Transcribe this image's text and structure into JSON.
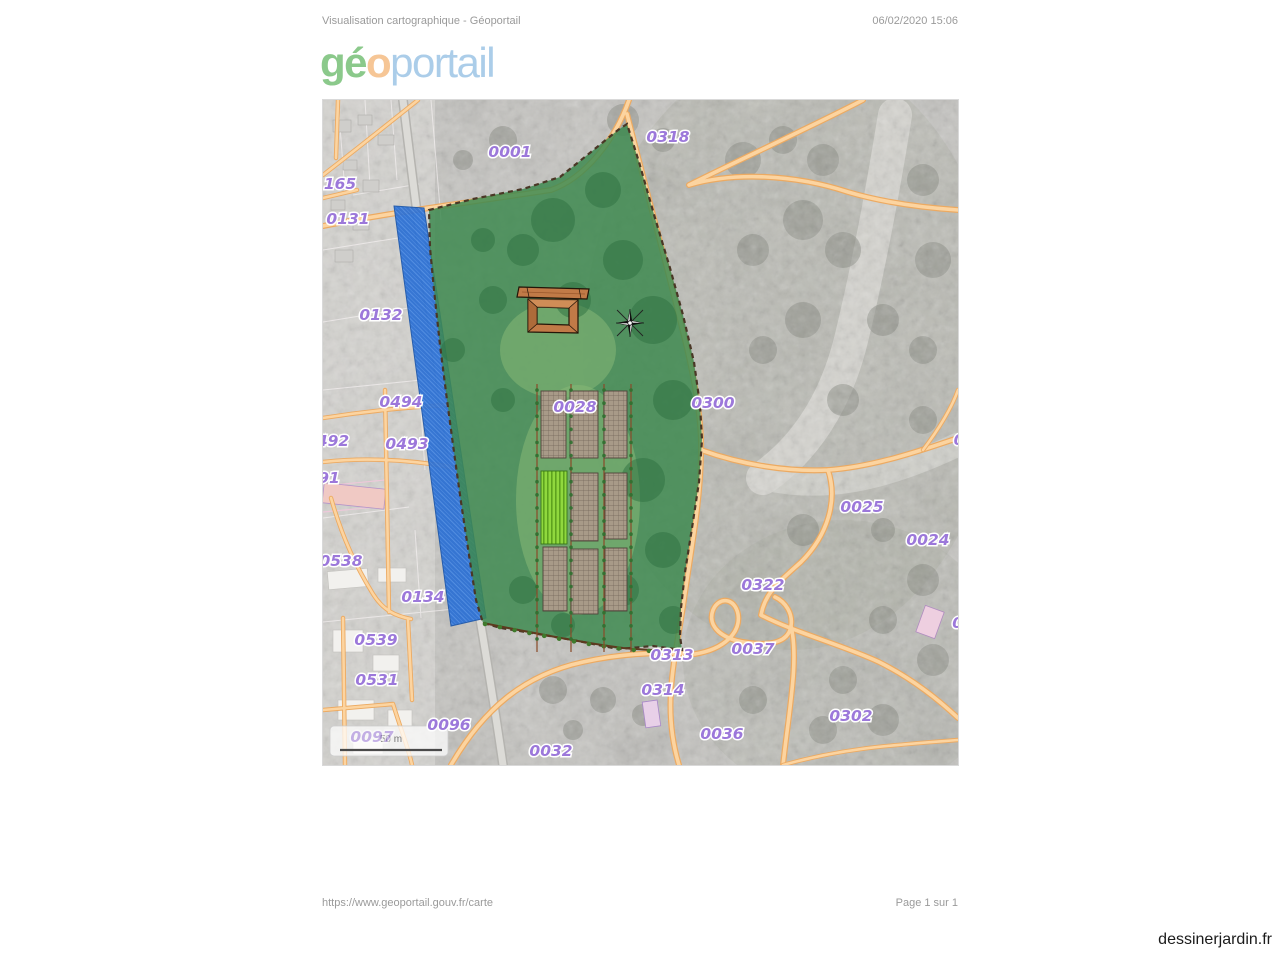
{
  "page": {
    "title": "Visualisation cartographique - Géoportail",
    "datetime": "06/02/2020 15:06",
    "footer_url": "https://www.geoportail.gouv.fr/carte",
    "footer_page": "Page 1 sur 1",
    "watermark": "dessinerjardin.fr"
  },
  "logo": {
    "segments": [
      {
        "text": "gé",
        "color": "#8bc98b"
      },
      {
        "text": "o",
        "color": "#f6c696"
      },
      {
        "text": "portail",
        "color": "#abcde9"
      }
    ]
  },
  "map": {
    "scale_label": "50 m",
    "colors": {
      "garden_overlay_green": "#3e8a50",
      "river_selection_blue": "#2a6fd4",
      "road_orange": "#fcd4a0",
      "parcel_label_purple": "#9c78da",
      "wood_structure_brown": "#c17a47"
    },
    "features": [
      {
        "name": "garden-area-overlay"
      },
      {
        "name": "river-selection-strip"
      },
      {
        "name": "pergola-structure"
      },
      {
        "name": "garden-beds"
      },
      {
        "name": "compass-rose"
      },
      {
        "name": "scale-bar"
      }
    ],
    "parcels": [
      {
        "label": "0001",
        "x": 187,
        "y": 57
      },
      {
        "label": "0318",
        "x": 345,
        "y": 42
      },
      {
        "label": "165",
        "x": 17,
        "y": 89
      },
      {
        "label": "0131",
        "x": 25,
        "y": 124
      },
      {
        "label": "0132",
        "x": 58,
        "y": 220
      },
      {
        "label": "0494",
        "x": 78,
        "y": 307
      },
      {
        "label": "492",
        "x": 10,
        "y": 346
      },
      {
        "label": "0493",
        "x": 84,
        "y": 349
      },
      {
        "label": "91",
        "x": 6,
        "y": 383
      },
      {
        "label": "0538",
        "x": 18,
        "y": 466
      },
      {
        "label": "0134",
        "x": 100,
        "y": 502
      },
      {
        "label": "0539",
        "x": 53,
        "y": 545
      },
      {
        "label": "0531",
        "x": 54,
        "y": 585
      },
      {
        "label": "0096",
        "x": 126,
        "y": 630
      },
      {
        "label": "0097",
        "x": 49,
        "y": 642,
        "dim": true
      },
      {
        "label": "0032",
        "x": 228,
        "y": 656
      },
      {
        "label": "0028",
        "x": 252,
        "y": 312
      },
      {
        "label": "0300",
        "x": 390,
        "y": 308
      },
      {
        "label": "0025",
        "x": 539,
        "y": 412
      },
      {
        "label": "0024",
        "x": 605,
        "y": 445
      },
      {
        "label": "0322",
        "x": 440,
        "y": 490
      },
      {
        "label": "0313",
        "x": 349,
        "y": 560
      },
      {
        "label": "0037",
        "x": 430,
        "y": 554
      },
      {
        "label": "0314",
        "x": 340,
        "y": 595
      },
      {
        "label": "0036",
        "x": 399,
        "y": 639
      },
      {
        "label": "0302",
        "x": 528,
        "y": 621
      },
      {
        "label": "0",
        "x": 636,
        "y": 345
      },
      {
        "label": "00",
        "x": 640,
        "y": 528
      }
    ]
  }
}
